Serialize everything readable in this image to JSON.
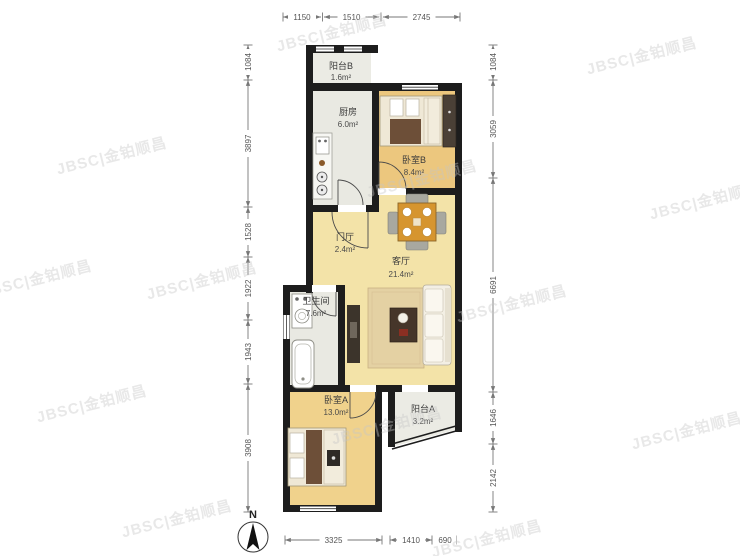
{
  "watermark": {
    "text": "JBSC|金铂顺昌"
  },
  "compass": {
    "label": "N"
  },
  "rooms": {
    "balcony_b": {
      "name": "阳台B",
      "area": "1.6m²"
    },
    "kitchen": {
      "name": "厨房",
      "area": "6.0m²"
    },
    "bedroom_b": {
      "name": "卧室B",
      "area": "8.4m²"
    },
    "hall": {
      "name": "门厅",
      "area": "2.4m²"
    },
    "living": {
      "name": "客厅",
      "area": "21.4m²"
    },
    "bath": {
      "name": "卫生间",
      "area": "7.6m²"
    },
    "bedroom_a": {
      "name": "卧室A",
      "area": "13.0m²"
    },
    "balcony_a": {
      "name": "阳台A",
      "area": "3.2m²"
    }
  },
  "dimensions": {
    "top": [
      "1150",
      "1510",
      "2745"
    ],
    "left": [
      "1084",
      "3897",
      "1528",
      "1922",
      "1943",
      "3908"
    ],
    "right": [
      "1084",
      "3059",
      "6691",
      "1646",
      "2142"
    ],
    "bottom": [
      "3325",
      "1410",
      "690"
    ]
  },
  "colors": {
    "wall": "#1d1d1d",
    "floor_living": "#f3e3a8",
    "floor_bedroom": "#ecc77e",
    "floor_bedroom_a": "#f0d28c",
    "floor_service": "#e9e9e2",
    "table_accent": "#d6952f",
    "dim_text": "#555555"
  }
}
